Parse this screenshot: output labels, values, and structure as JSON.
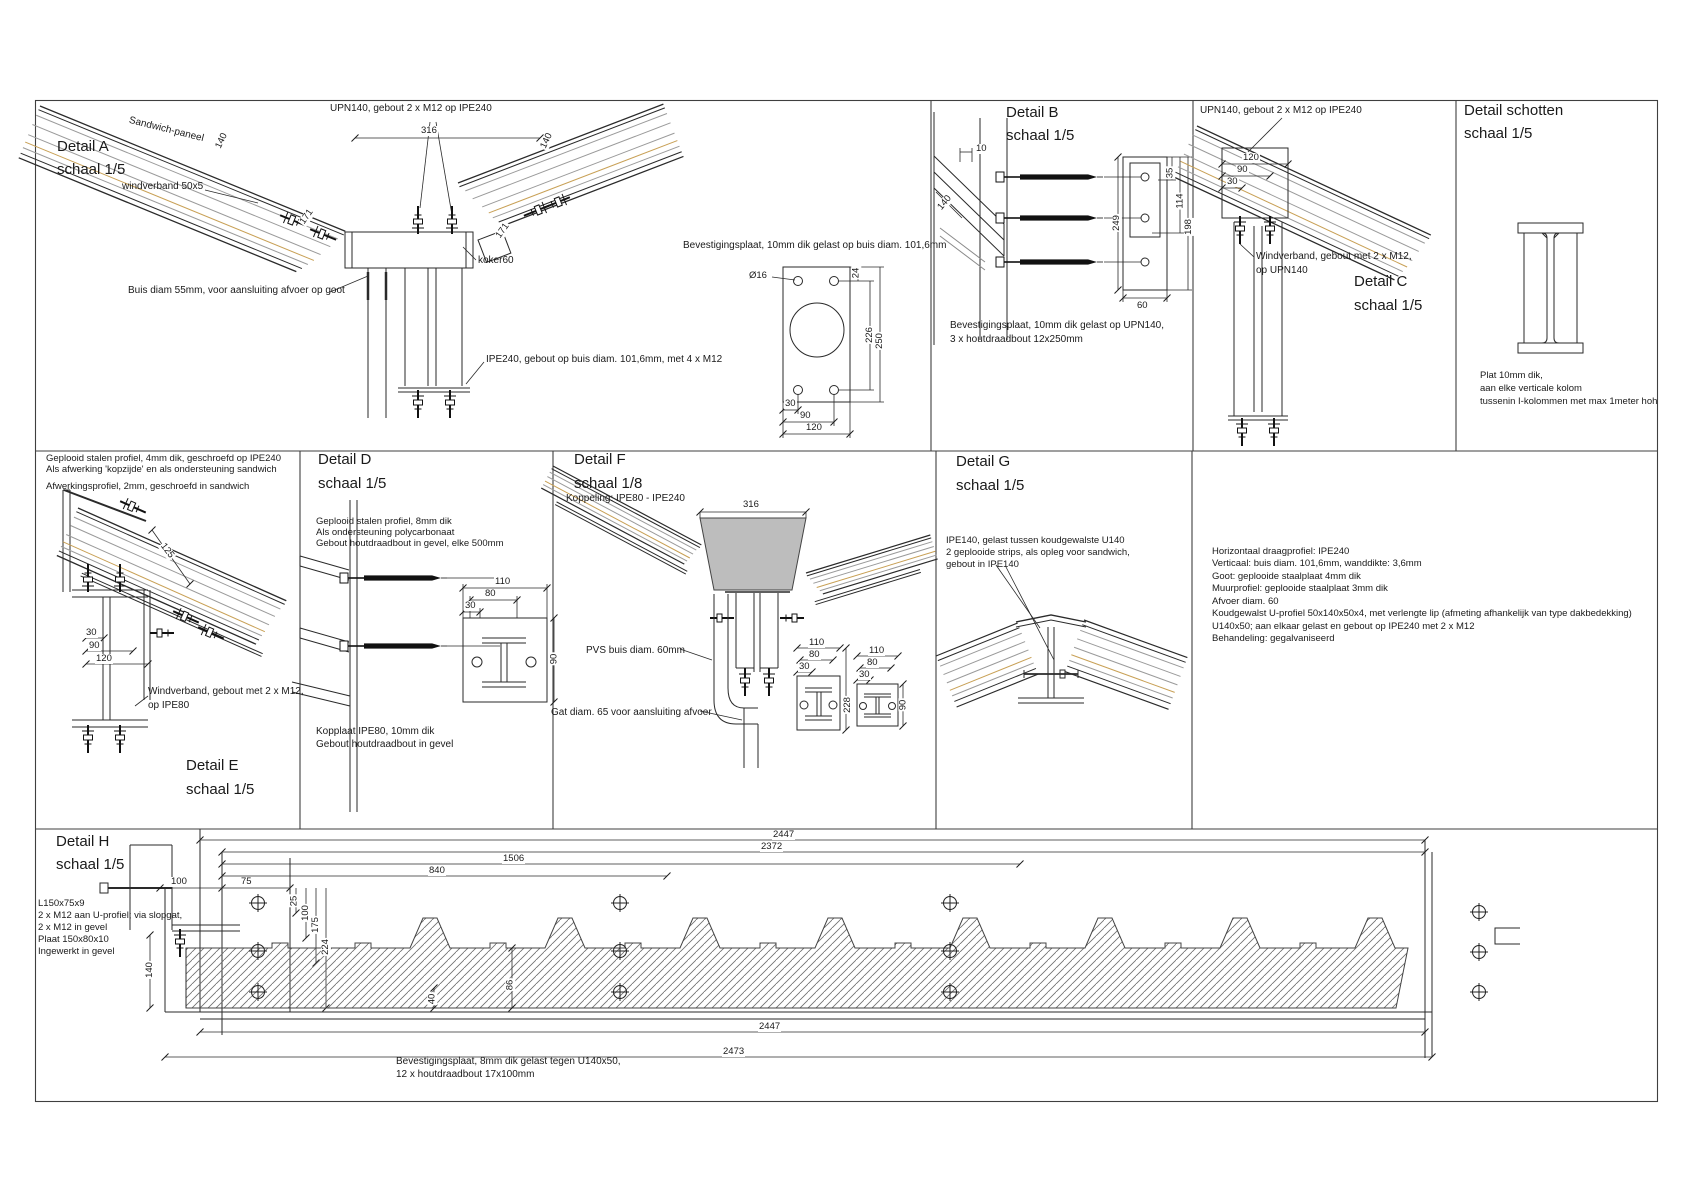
{
  "colors": {
    "tan": "#c8a055",
    "gray_line": "#9a9a9a",
    "ink": "#2a2a2a",
    "gutter_gray": "#bdbdbd"
  },
  "detail_a": {
    "title": "Detail A",
    "scale": "schaal 1/5",
    "lbl_sandwich": "Sandwich-paneel",
    "lbl_windverband": "windverband 50x5",
    "lbl_upn": "UPN140, gebout 2 x M12 op IPE240",
    "lbl_buis": "Buis diam 55mm, voor aansluiting afvoer op goot",
    "lbl_koker": "koker60",
    "lbl_ipe": "IPE240, gebout op buis diam. 101,6mm, met 4 x M12",
    "lbl_plaat": "Bevestigingsplaat, 10mm dik gelast op buis diam. 101,6mm",
    "lbl_dia": "Ø16",
    "dims": {
      "w316": "316",
      "t140_l": "140",
      "t140_r": "140",
      "s171_l": "171",
      "s171_r": "171",
      "h24": "24",
      "h226": "226",
      "h250": "250",
      "b30": "30",
      "b90": "90",
      "b120": "120"
    }
  },
  "detail_b": {
    "title": "Detail B",
    "scale": "schaal 1/5",
    "note_line1": "Bevestigingsplaat, 10mm dik gelast op UPN140,",
    "note_line2": "3 x houtdraadbout 12x250mm",
    "dims": {
      "d10": "10",
      "d140": "140",
      "d249": "249",
      "d35": "35",
      "d114": "114",
      "d198": "198",
      "d60": "60"
    }
  },
  "detail_c": {
    "title": "Detail C",
    "scale": "schaal 1/5",
    "lbl_upn": "UPN140, gebout 2 x M12 op IPE240",
    "lbl_wind1": "Windverband, gebout met 2 x M12,",
    "lbl_wind2": "op UPN140",
    "dims": {
      "d120": "120",
      "d90": "90",
      "d30": "30"
    }
  },
  "detail_s": {
    "title": "Detail schotten",
    "scale": "schaal 1/5",
    "note_line1": "Plat 10mm dik,",
    "note_line2": "aan elke verticale kolom",
    "note_line3": "tussenin I-kolommen met max 1meter hoh"
  },
  "detail_e": {
    "title": "Detail E",
    "scale": "schaal 1/5",
    "note_line1": "Geplooid stalen profiel, 4mm dik, geschroefd op IPE240",
    "note_line2": "Als afwerking 'kopzijde' en als ondersteuning sandwich",
    "note_line3": "Afwerkingsprofiel, 2mm, geschroefd in sandwich",
    "lbl_wind1": "Windverband, gebout met 2 x M12,",
    "lbl_wind2": "op IPE80",
    "dims": {
      "d125": "125",
      "d30": "30",
      "d90": "90",
      "d120": "120"
    }
  },
  "detail_d": {
    "title": "Detail D",
    "scale": "schaal 1/5",
    "note_line1": "Geplooid stalen profiel, 8mm dik",
    "note_line2": "Als ondersteuning polycarbonaat",
    "note_line3": "Gebout houtdraadbout in gevel, elke 500mm",
    "lbl_kop1": "Kopplaat IPE80, 10mm dik",
    "lbl_kop2": "Gebout houtdraadbout in gevel",
    "dims": {
      "d110": "110",
      "d80": "80",
      "d30": "30",
      "d90": "90"
    }
  },
  "detail_f": {
    "title": "Detail F",
    "scale": "schaal 1/8",
    "subtitle": "Koppeling: IPE80 - IPE240",
    "lbl_pvs": "PVS buis diam. 60mm",
    "lbl_gat": "Gat diam. 65 voor aansluiting afvoer",
    "dims": {
      "w316": "316",
      "p1_110": "110",
      "p1_80": "80",
      "p1_30": "30",
      "p1_228": "228",
      "p2_110": "110",
      "p2_80": "80",
      "p2_30": "30",
      "p2_90": "90"
    }
  },
  "detail_g": {
    "title": "Detail G",
    "scale": "schaal 1/5",
    "note_line1": "IPE140, gelast tussen koudgewalste U140",
    "note_line2": "2 geplooide strips, als opleg voor sandwich,",
    "note_line3": "gebout in IPE140"
  },
  "spec_notes": {
    "line1": "Horizontaal draagprofiel: IPE240",
    "line2": "Verticaal: buis diam. 101,6mm, wanddikte: 3,6mm",
    "line3": "Goot: geplooide staalplaat 4mm dik",
    "line4": "Muurprofiel: geplooide staalplaat 3mm dik",
    "line5": "Afvoer diam. 60",
    "line6": "Koudgewalst U-profiel 50x140x50x4, met verlengte lip (afmeting afhankelijk van type dakbedekking)",
    "line7": "U140x50; aan elkaar gelast en gebout op IPE240 met 2 x M12",
    "line8": "Behandeling: gegalvaniseerd"
  },
  "detail_h": {
    "title": "Detail H",
    "scale": "schaal 1/5",
    "note_l1": "L150x75x9",
    "note_l2": "2 x M12 aan U-profiel; via slopgat,",
    "note_l3": "2 x M12 in gevel",
    "note_l4": "Plaat 150x80x10",
    "note_l5": "Ingewerkt in gevel",
    "note_b1": "Bevestigingsplaat, 8mm dik gelast tegen U140x50,",
    "note_b2": "12 x houtdraadbout 17x100mm",
    "dims": {
      "top2447": "2447",
      "d2372": "2372",
      "d1506": "1506",
      "d840": "840",
      "d100l": "100",
      "d75": "75",
      "d25": "25",
      "d100v": "100",
      "d175": "175",
      "d224": "224",
      "d140": "140",
      "d40": "40",
      "d86": "86",
      "bot2447": "2447",
      "d2473": "2473"
    }
  }
}
